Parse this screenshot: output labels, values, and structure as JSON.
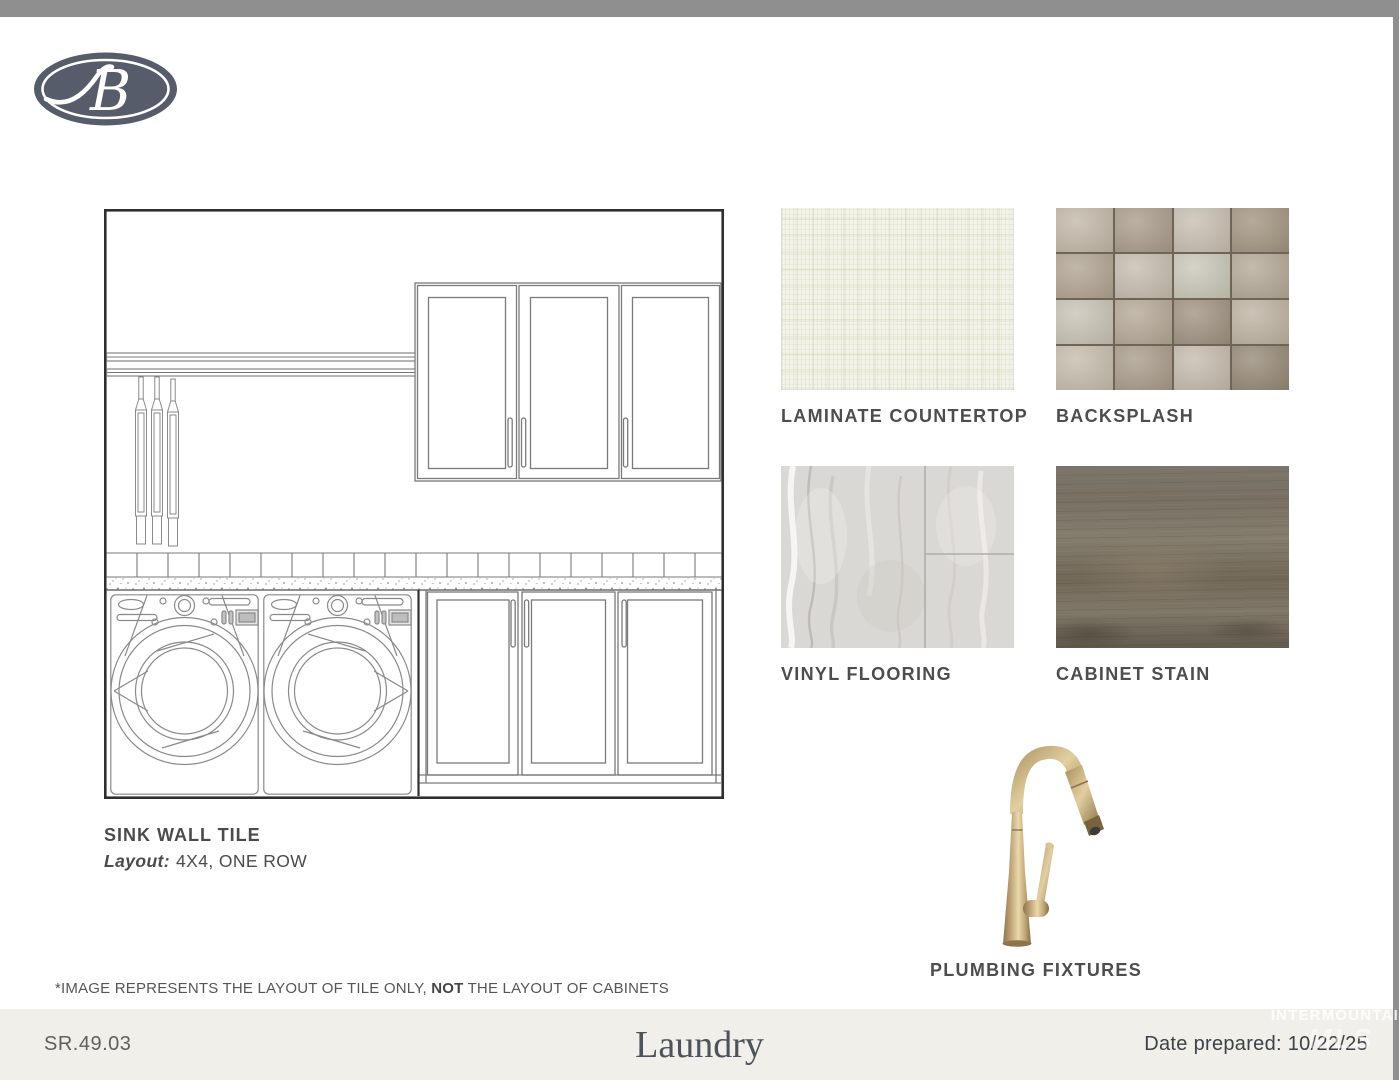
{
  "logo": {
    "letter": "B"
  },
  "drawing_caption": {
    "title": "SINK WALL TILE",
    "layout_label": "Layout:",
    "layout_value": "4X4, ONE ROW"
  },
  "swatches": [
    {
      "label": "LAMINATE COUNTERTOP"
    },
    {
      "label": "BACKSPLASH"
    },
    {
      "label": "VINYL FLOORING"
    },
    {
      "label": "CABINET STAIN"
    }
  ],
  "plumbing_label": "PLUMBING FIXTURES",
  "disclaimer": {
    "part1": "*IMAGE REPRESENTS THE LAYOUT OF TILE ONLY, ",
    "emphasis": "NOT",
    "part2": " THE LAYOUT OF CABINETS"
  },
  "footer": {
    "code": "SR.49.03",
    "room_title": "Laundry",
    "date_prepared": "Date prepared: 10/22/25"
  },
  "watermark": {
    "line1": "INTERMOUNTAIN",
    "line2": "MLS"
  },
  "backsplash_tiles": [
    "#c2b7a7",
    "#a89b8a",
    "#c6bfb0",
    "#a2947f",
    "#b0a391",
    "#c4bcae",
    "#c9c6b8",
    "#b3a896",
    "#c8c2b4",
    "#b4a795",
    "#9f9180",
    "#bdb2a1",
    "#c5bcab",
    "#a89b89",
    "#c3bbac",
    "#958875"
  ],
  "colors": {
    "brand_navy": "#565c6a",
    "footer_bg": "#f1efe9",
    "chrome_gray": "#8f8f8f",
    "faucet_finish_gold": "#c9ae7c",
    "grout": "#6e6557"
  }
}
